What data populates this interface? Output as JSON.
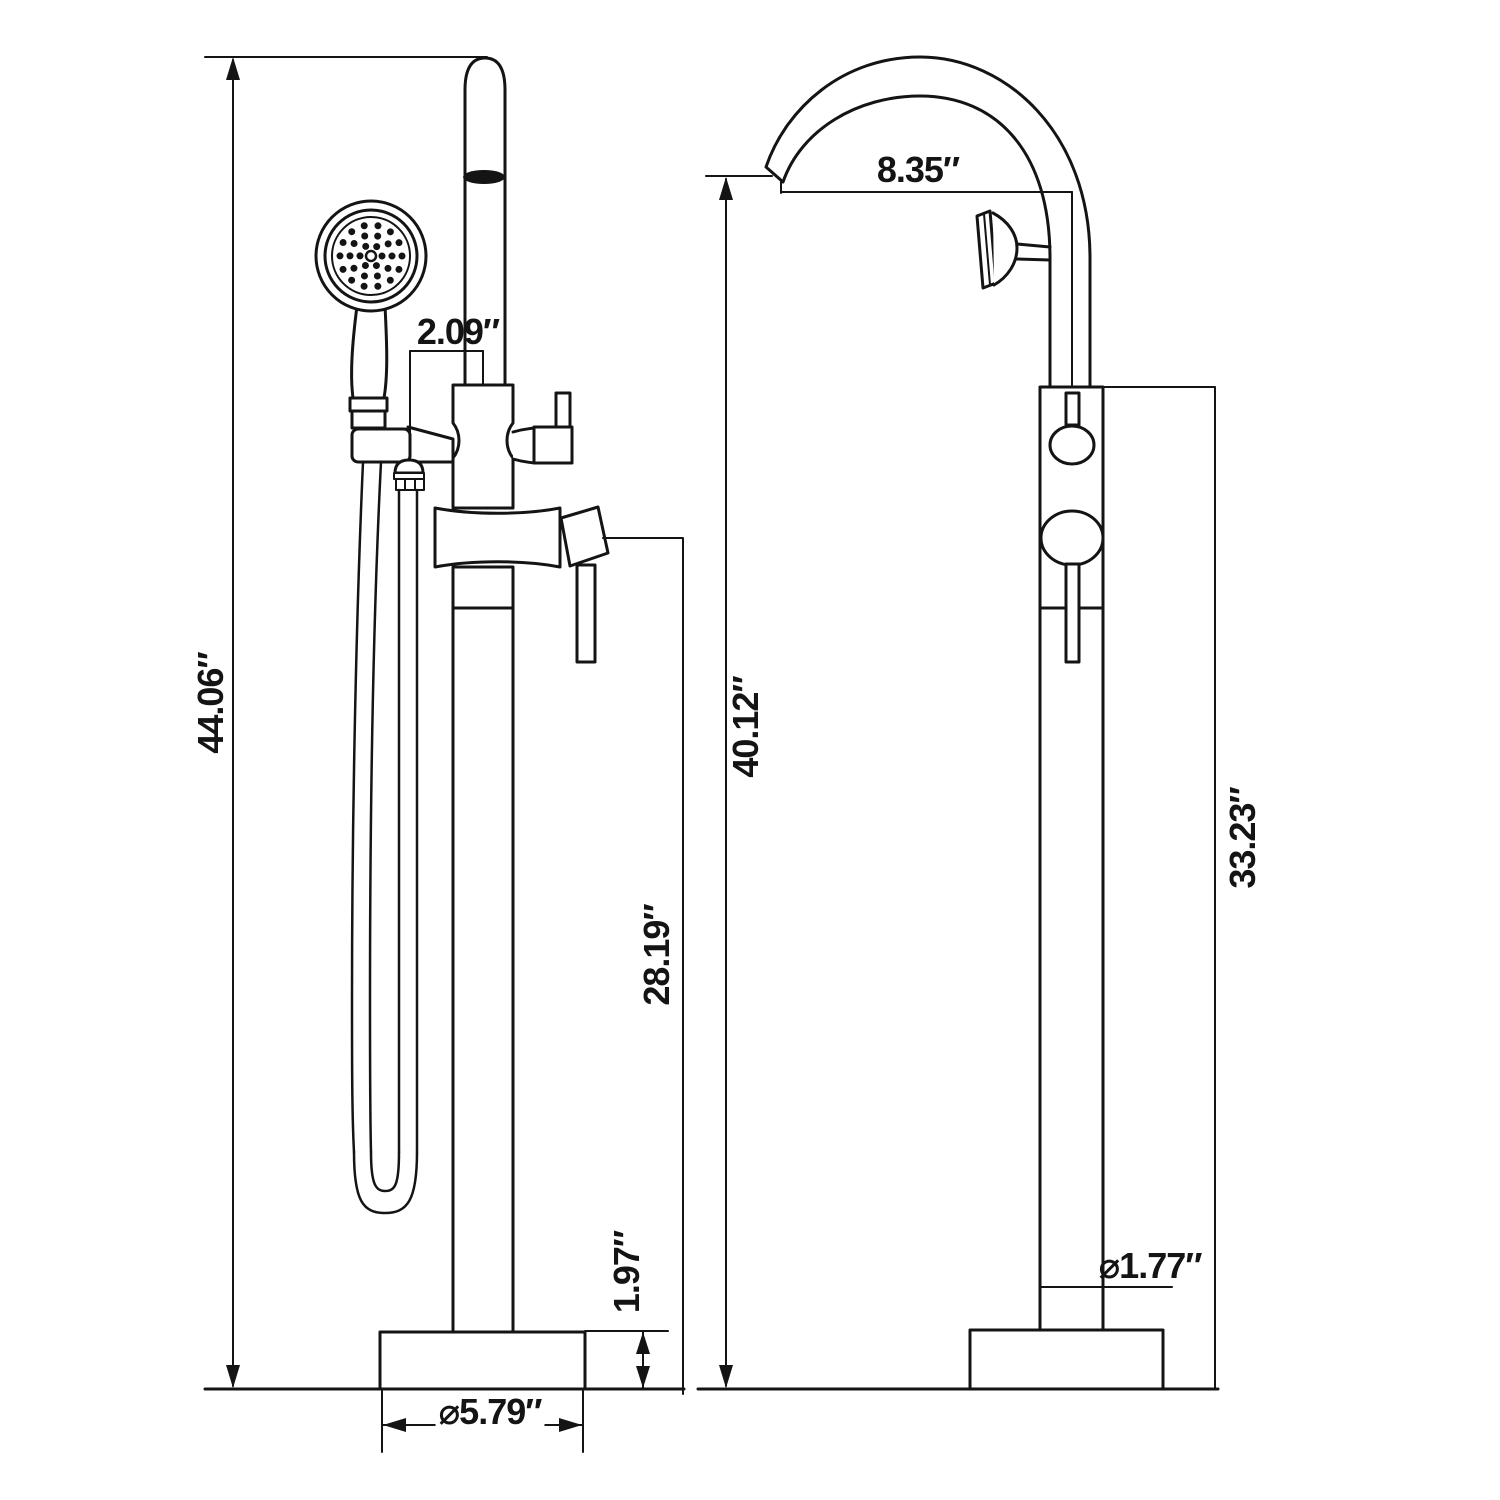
{
  "page": {
    "background": "#ffffff",
    "line_color": "#141414"
  },
  "diagram": {
    "type": "technical-dimension-drawing",
    "views": [
      "front-view-with-hand-shower",
      "side-view-with-gooseneck-spout"
    ]
  },
  "dimensions": {
    "overall_height": {
      "label": "44.06″"
    },
    "hand_shower_offset": {
      "label": "2.09″"
    },
    "spout_reach": {
      "label": "8.35″"
    },
    "spout_height": {
      "label": "40.12″"
    },
    "handle_height": {
      "label": "28.19″"
    },
    "column_height": {
      "label": "33.23″"
    },
    "base_thickness": {
      "label": "1.97″"
    },
    "base_diameter": {
      "label": "⌀5.79″"
    },
    "pipe_diameter": {
      "label": "⌀1.77″"
    }
  }
}
